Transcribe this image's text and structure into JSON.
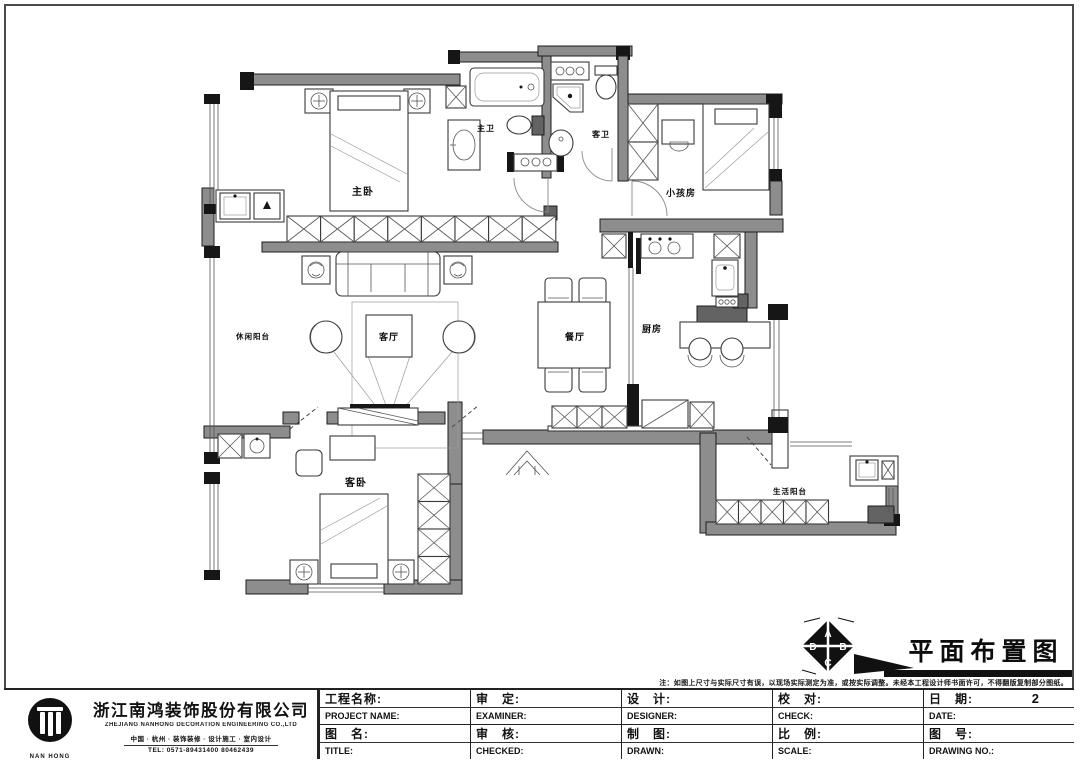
{
  "plan": {
    "rooms": [
      {
        "name": "master-bedroom",
        "label": "主卧"
      },
      {
        "name": "master-bath",
        "label": "主卫"
      },
      {
        "name": "guest-bath",
        "label": "客卫"
      },
      {
        "name": "kids-room",
        "label": "小孩房"
      },
      {
        "name": "kitchen",
        "label": "厨房"
      },
      {
        "name": "dining-room",
        "label": "餐厅"
      },
      {
        "name": "living-room",
        "label": "客厅"
      },
      {
        "name": "leisure-balcony",
        "label": "休闲阳台"
      },
      {
        "name": "guest-bedroom",
        "label": "客卧"
      },
      {
        "name": "service-balcony",
        "label": "生活阳台"
      }
    ]
  },
  "drawing_title": {
    "text": "平面布置图"
  },
  "compass": {
    "top": "A",
    "right": "B",
    "bottom": "C",
    "left": "D"
  },
  "annotation": {
    "note": "注：如图上尺寸与实际尺寸有误，以现场实际测定为准，或按实际调整。未经本工程设计师书面许可，不得翻版复制部分图纸。"
  },
  "company": {
    "name": "浙江南鸿装饰股份有限公司",
    "name_en": "ZHEJIANG NANHONG DECORATION ENGINEERING CO.,LTD",
    "tagline": "中国 · 杭州 · 装饰装修 · 设计施工 · 室内设计",
    "tel": "TEL: 0571-89431400 80462439",
    "logo_text": "NAN HONG"
  },
  "title_block": {
    "cells": [
      {
        "zh": "工程名称:",
        "en": "PROJECT NAME:",
        "value": ""
      },
      {
        "zh": "审　定:",
        "en": "EXAMINER:",
        "value": ""
      },
      {
        "zh": "设　计:",
        "en": "DESIGNER:",
        "value": ""
      },
      {
        "zh": "校　对:",
        "en": "CHECK:",
        "value": ""
      },
      {
        "zh": "日　期:",
        "en": "DATE:",
        "value": "2"
      },
      {
        "zh": "图　名:",
        "en": "TITLE:",
        "value": ""
      },
      {
        "zh": "审　核:",
        "en": "CHECKED:",
        "value": ""
      },
      {
        "zh": "制　图:",
        "en": "DRAWN:",
        "value": ""
      },
      {
        "zh": "比　例:",
        "en": "SCALE:",
        "value": ""
      },
      {
        "zh": "图　号:",
        "en": "DRAWING NO.:",
        "value": ""
      }
    ]
  }
}
